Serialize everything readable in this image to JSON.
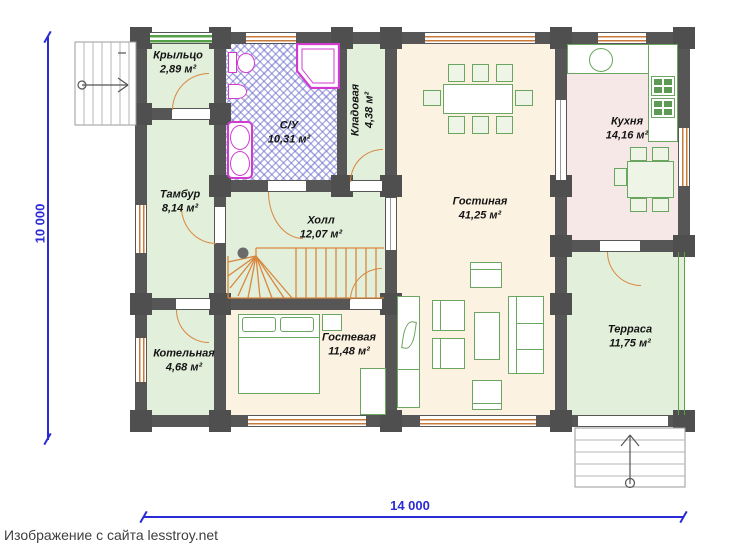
{
  "caption": "Изображение с сайта lesstroy.net",
  "dimensions": {
    "vertical": "10 000",
    "horizontal": "14 000"
  },
  "rooms": [
    {
      "id": "porch",
      "name": "Крыльцо",
      "area": "2,89 м²"
    },
    {
      "id": "bathroom",
      "name": "С/У",
      "area": "10,31 м²"
    },
    {
      "id": "storage",
      "name": "Кладовая",
      "area": "4,38 м²"
    },
    {
      "id": "vestibule",
      "name": "Тамбур",
      "area": "8,14 м²"
    },
    {
      "id": "hall",
      "name": "Холл",
      "area": "12,07 м²"
    },
    {
      "id": "living",
      "name": "Гостиная",
      "area": "41,25 м²"
    },
    {
      "id": "kitchen",
      "name": "Кухня",
      "area": "14,16 м²"
    },
    {
      "id": "boiler",
      "name": "Котельная",
      "area": "4,68 м²"
    },
    {
      "id": "guest",
      "name": "Гостевая",
      "area": "11,48 м²"
    },
    {
      "id": "terrace",
      "name": "Терраса",
      "area": "11,75 м²"
    }
  ],
  "colors": {
    "wall": "#565656",
    "room_green": "#e2efdb",
    "room_cream": "#fcf2e2",
    "room_pink": "#f7e8e8",
    "furniture_green": "#6aa65f",
    "sanitary_magenta": "#d23bd2",
    "door_orange": "#d8873f",
    "dimension_blue": "#2b2bd5",
    "bath_hatch": "#6e6ecd"
  }
}
